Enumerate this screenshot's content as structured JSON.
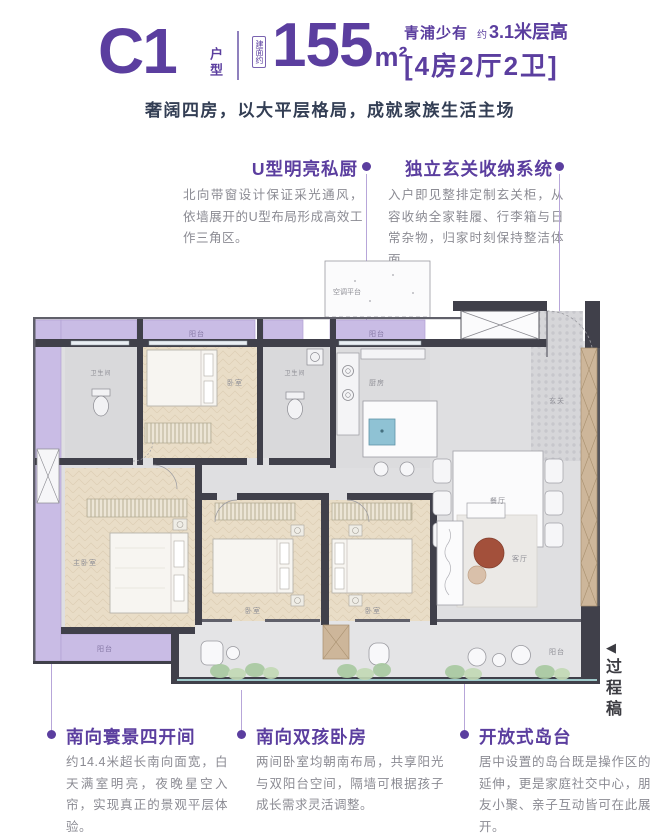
{
  "header": {
    "unit_code": "C1",
    "unit_label": "户型",
    "area_prefix": "建面约",
    "area_value": "155",
    "area_unit": "m²",
    "rarity": "青浦少有",
    "height_approx": "约",
    "height_value": "3.1米层高",
    "layout_spec": "[4房2厅2卫]",
    "subtitle": "奢阔四房，以大平层格局，成就家族生活主场"
  },
  "callouts_top": [
    {
      "title": "U型明亮私厨",
      "body": "北向带窗设计保证采光通风，依墙展开的U型布局形成高效工作三角区。"
    },
    {
      "title": "独立玄关收纳系统",
      "body": "入户即见整排定制玄关柜，从容收纳全家鞋履、行李箱与日常杂物，归家时刻保持整洁体面。"
    }
  ],
  "callouts_bottom": [
    {
      "title": "南向寰景四开间",
      "body": "约14.4米超长南向面宽，白天满室明亮，夜晚星空入帘，实现真正的景观平层体验。"
    },
    {
      "title": "南向双孩卧房",
      "body": "两间卧室均朝南布局，共享阳光与双阳台空间，隔墙可根据孩子成长需求灵活调整。"
    },
    {
      "title": "开放式岛台",
      "body": "居中设置的岛台既是操作区的延伸，更是家庭社交中心，朋友小聚、亲子互动皆可在此展开。"
    }
  ],
  "floorplan": {
    "labels": {
      "balcony": "阳台",
      "ac_platform": "空调平台",
      "master_bedroom": "主卧室",
      "bedroom": "卧室",
      "living_room": "客厅",
      "dining_room": "餐厅",
      "kitchen": "厨房",
      "foyer": "玄关",
      "bathroom": "卫生间"
    }
  },
  "watermark": {
    "arrow": "◀",
    "label": "过程稿"
  },
  "colors": {
    "accent_purple": "#5b3e9f",
    "balcony_purple": "#c9bce5",
    "wall_dark": "#40404a",
    "body_gray": "#8b8b93",
    "wood_floor": "#e9ddc7",
    "sink_blue": "#8fc2d4",
    "table_brown": "#a3503b"
  }
}
